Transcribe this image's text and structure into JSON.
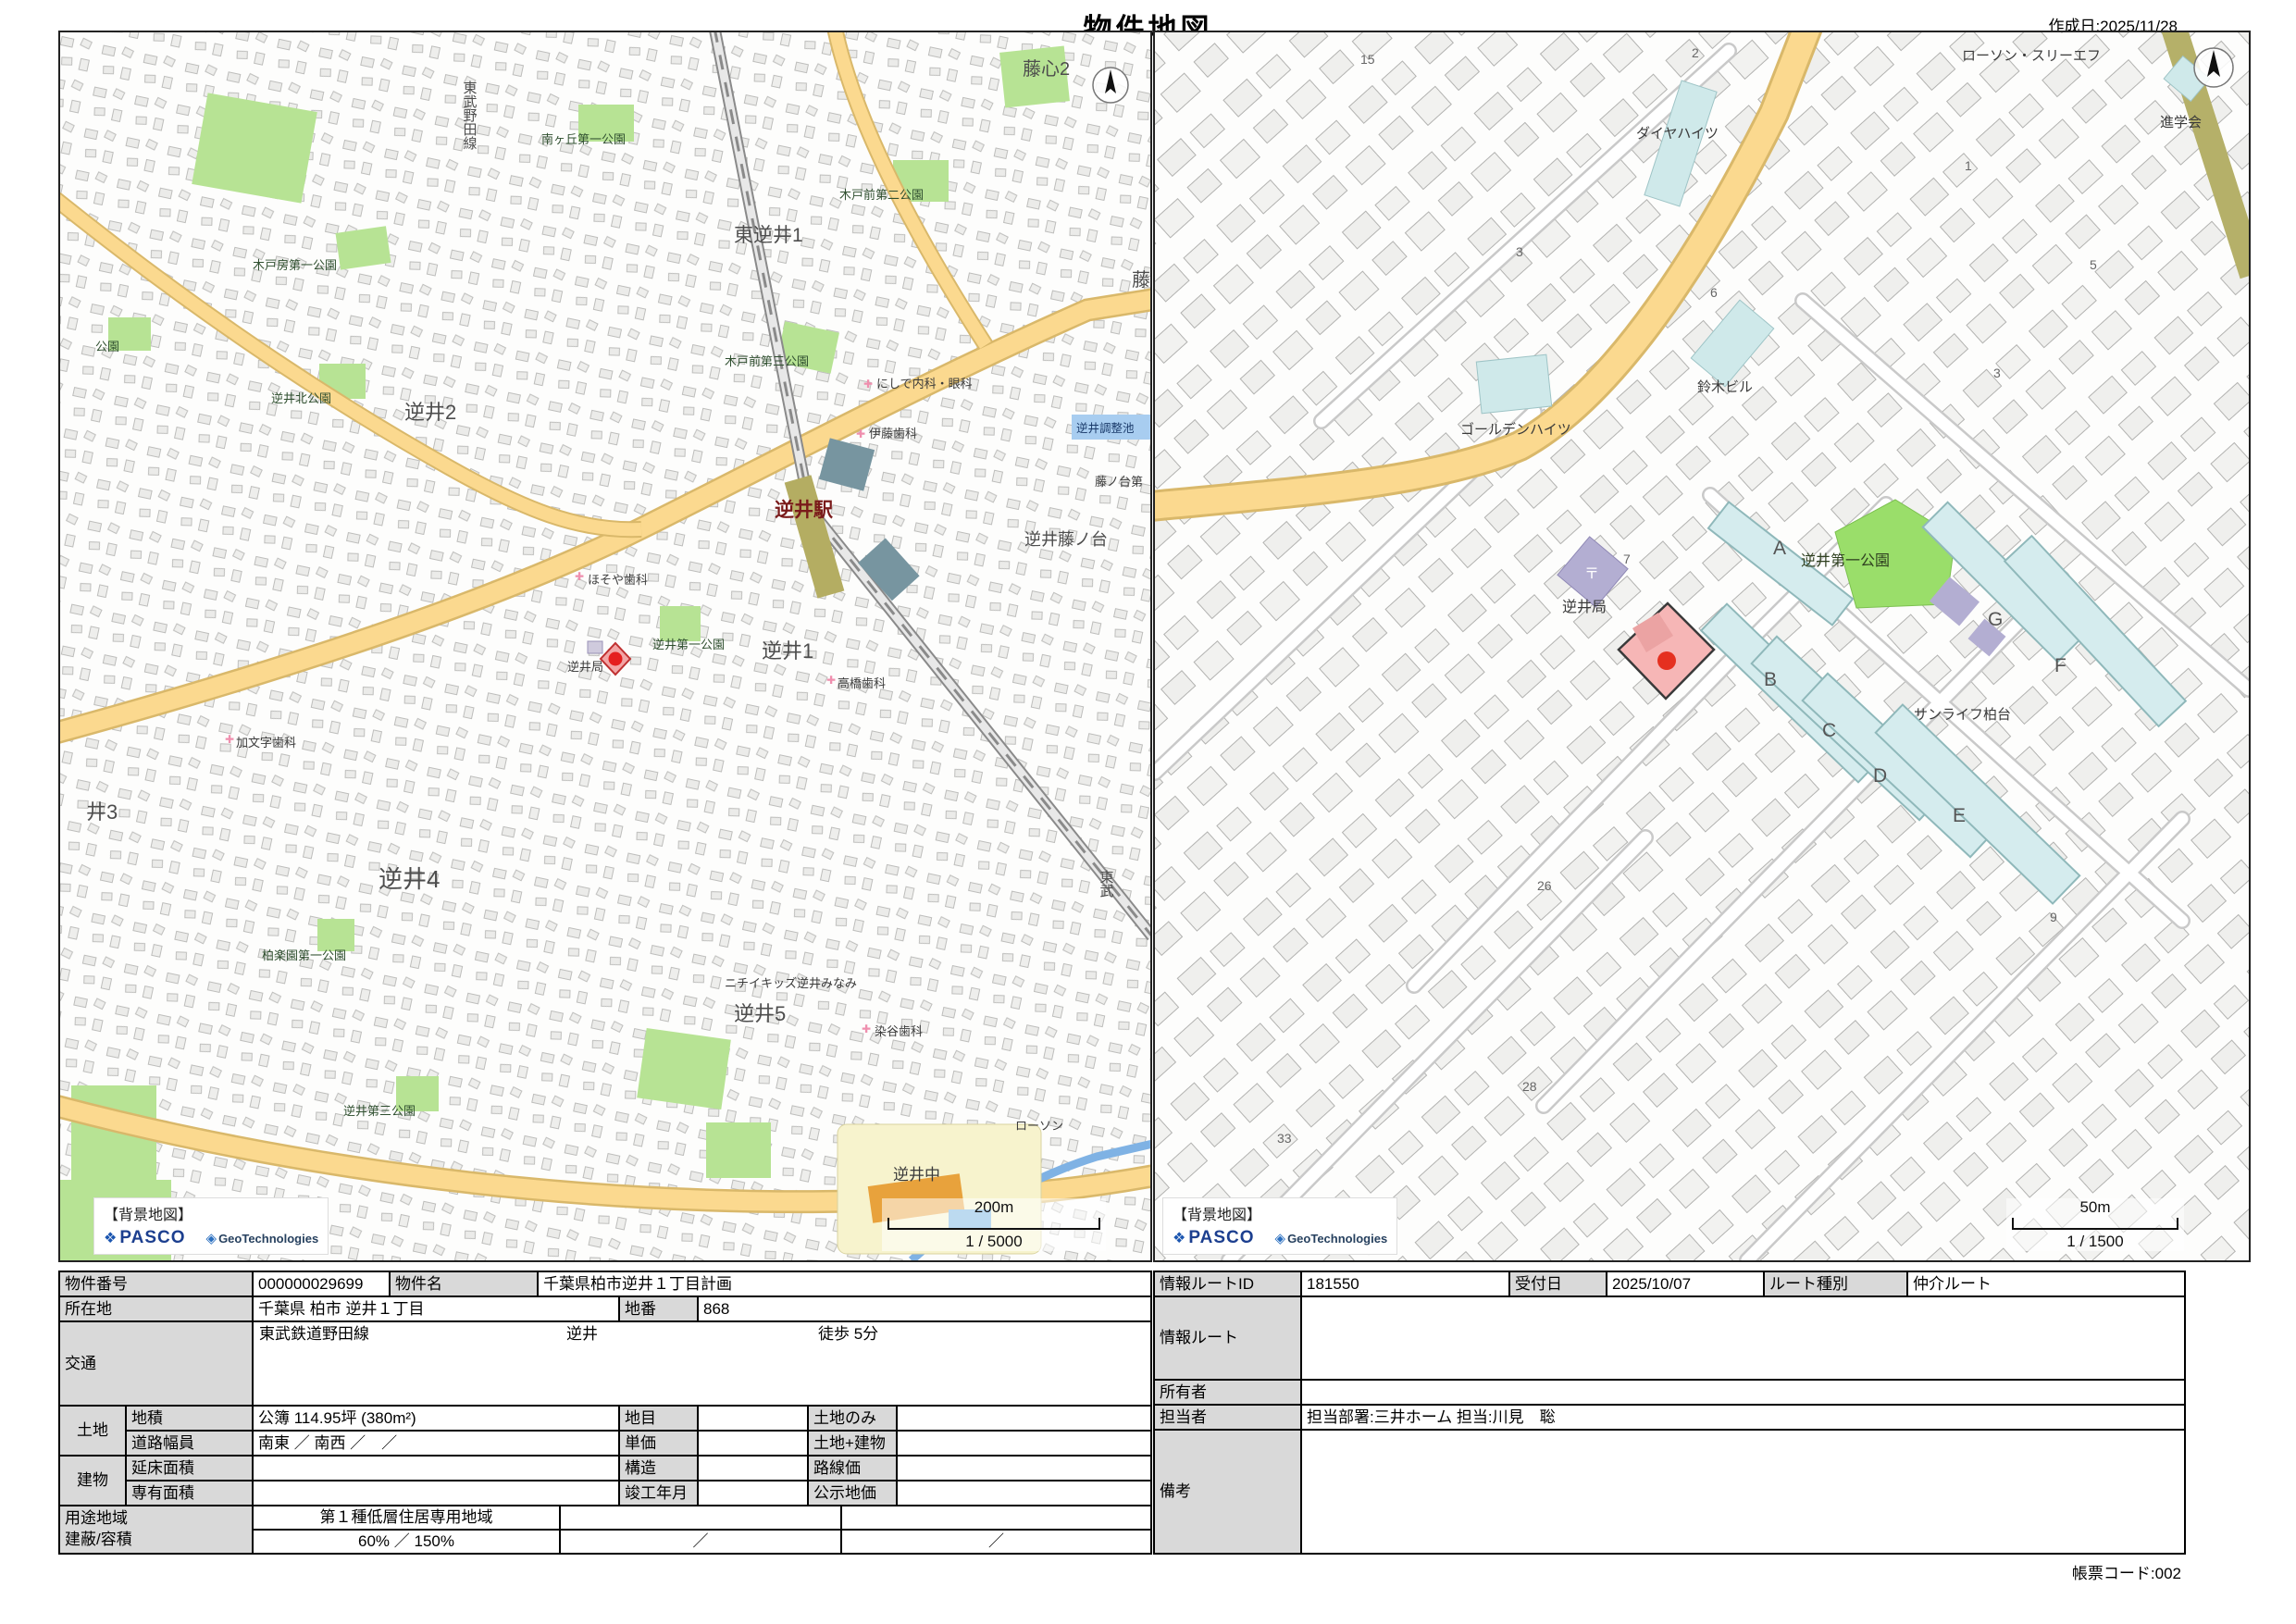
{
  "page": {
    "title": "物件地図",
    "created": "作成日:2025/11/28",
    "form_code": "帳票コード:002"
  },
  "credits": {
    "title": "【背景地図】",
    "pasco": "PASCO",
    "geo": "GeoTechnologies"
  },
  "left_map": {
    "scale_dist": "200m",
    "scale_ratio": "1 / 5000",
    "labels": {
      "fujigokoro2": "藤心2",
      "tobu_noda_line": "東武野田線",
      "minamigaoka_park": "南ヶ丘第一公園",
      "kidobo_park": "木戸房第一公園",
      "higashi_sakasai1": "東逆井1",
      "kidomae2_park": "木戸前第二公園",
      "park": "公園",
      "sakasai_kita_park": "逆井北公園",
      "sakasai2": "逆井2",
      "kidomae3_park": "木戸前第三公園",
      "nishide_clinic": "にしで内科・眼科",
      "ito_dental": "伊藤歯科",
      "chosei_pond": "逆井調整池",
      "fujinodai_dai": "藤ノ台第",
      "fuji": "藤",
      "station": "逆井駅",
      "sakasai_fujinodai": "逆井藤ノ台",
      "hosoya_dental": "ほそや歯科",
      "sakasai_dai1_park": "逆井第一公園",
      "sakasai1": "逆井1",
      "sakasai_post": "逆井局",
      "takahashi_dental": "高橋歯科",
      "kamonji_dental": "加文字歯科",
      "i3": "井3",
      "sakasai4": "逆井4",
      "kashiwa_rakuen_park": "柏楽園第一公園",
      "nichii_kids": "ニチイキッズ逆井みなみ",
      "sakasai5": "逆井5",
      "someya_dental": "染谷歯科",
      "sakasai_dai3_park": "逆井第三公園",
      "lawson": "ローソン",
      "junior_high": "逆井中",
      "tobu": "東武"
    }
  },
  "right_map": {
    "scale_dist": "50m",
    "scale_ratio": "1 / 1500",
    "labels": {
      "lawson_three_f": "ローソン・スリーエフ",
      "shingakukai": "進学会",
      "daiya_heights": "ダイヤハイツ",
      "golden_heights": "ゴールデンハイツ",
      "suzuki_building": "鈴木ビル",
      "sakasai_post": "逆井局",
      "post_mark": "〒",
      "sakasai_dai1_park": "逆井第一公園",
      "sunlife_kashiwadai": "サンライフ柏台"
    },
    "blocks": {
      "a": "A",
      "b": "B",
      "c": "C",
      "d": "D",
      "e": "E",
      "f": "F",
      "g": "G"
    },
    "numbers": {
      "n15": "15",
      "n2": "2",
      "n3a": "3",
      "n6": "6",
      "n1": "1",
      "n5": "5",
      "n3b": "3",
      "n7": "7",
      "n9": "9",
      "n26": "26",
      "n28": "28",
      "n33": "33"
    }
  },
  "left_table": {
    "property_no_label": "物件番号",
    "property_no": "000000029699",
    "property_name_label": "物件名",
    "property_name": "千葉県柏市逆井１丁目計画",
    "location_label": "所在地",
    "location": "千葉県 柏市 逆井１丁目",
    "lot_no_label": "地番",
    "lot_no": "868",
    "transport_label": "交通",
    "transport_line": "東武鉄道野田線",
    "transport_station": "逆井",
    "transport_walk": "徒歩 5分",
    "land_label": "土地",
    "land_area_label": "地積",
    "land_area": "公簿 114.95坪 (380m²)",
    "land_category_label": "地目",
    "land_category": "",
    "land_only_label": "土地のみ",
    "land_only": "",
    "road_width_label": "道路幅員",
    "road_width": "南東 ／ 南西 ／　／",
    "unit_price_label": "単価",
    "unit_price": "",
    "land_building_label": "土地+建物",
    "land_building": "",
    "building_label": "建物",
    "total_floor_label": "延床面積",
    "total_floor": "",
    "structure_label": "構造",
    "structure": "",
    "exclusive_area_label": "専有面積",
    "exclusive_area": "",
    "completion_label": "竣工年月",
    "completion": "",
    "route_price_label": "路線価",
    "route_price": "",
    "official_price_label": "公示地価",
    "official_price": "",
    "zoning_label": "用途地域",
    "coverage_label": "建蔽/容積",
    "zoning": "第１種低層住居専用地域",
    "zoning2": "",
    "zoning3": "",
    "coverage": "60% ／ 150%",
    "coverage2": "／",
    "coverage3": "／"
  },
  "right_table": {
    "info_route_id_label": "情報ルートID",
    "info_route_id": "181550",
    "reception_date_label": "受付日",
    "reception_date": "2025/10/07",
    "route_type_label": "ルート種別",
    "route_type": "仲介ルート",
    "info_route_label": "情報ルート",
    "info_route": "",
    "owner_label": "所有者",
    "owner": "",
    "staff_label": "担当者",
    "staff": "担当部署:三井ホーム 担当:川見　聡",
    "remarks_label": "備考",
    "remarks": ""
  },
  "colors": {
    "road_yellow": "#fbd98f",
    "park_green": "#b7e394",
    "park_green_bright": "#9ade6a",
    "block_cyan": "#d5ecee",
    "marker_red": "#e53020",
    "parcel_pink": "#f6b6b6"
  }
}
